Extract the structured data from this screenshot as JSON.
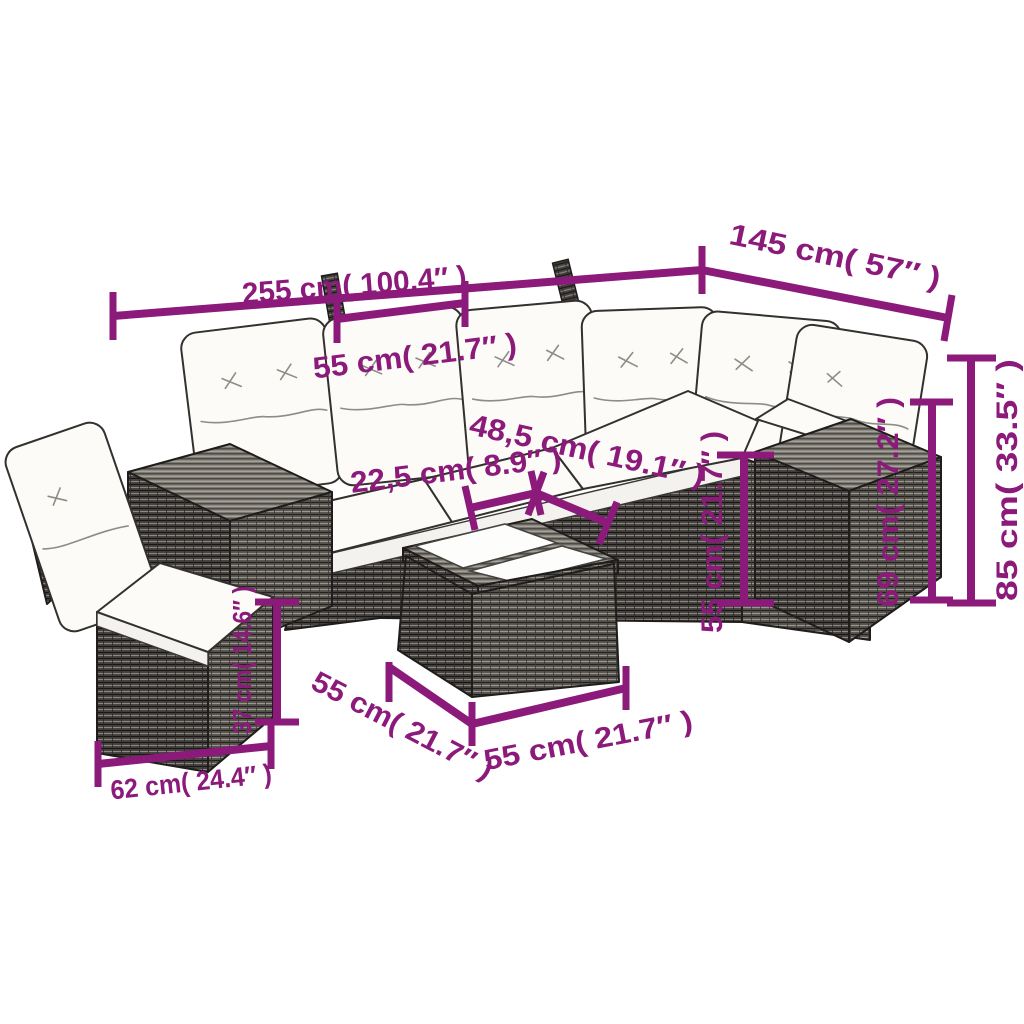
{
  "title": "rattan lounge set dimension diagram",
  "colors": {
    "accent": "#8b1a7b",
    "background": "#ffffff",
    "rattan_dark": "#44413e",
    "rattan_top": "#8e8a84",
    "cushion": "#fcfbf8"
  },
  "dimensions": {
    "total_width": "255 cm( 100.4″ )",
    "total_depth": "145 cm( 57″ )",
    "seat_width": "55 cm( 21.7″ )",
    "corner_seat_depth": "48,5 cm( 19.1″ )",
    "armrest_width": "22,5 cm( 8.9″ )",
    "seat_front_height": "55 cm( 21.7″ )",
    "armrest_box_height": "69 cm( 27.2″ )",
    "total_height": "85 cm( 33.5″ )",
    "chair_seat_height": "37 cm( 14.6″ )",
    "chair_width": "62 cm( 24.4″ )",
    "table_width": "55 cm( 21.7″ )",
    "table_depth": "55 cm( 21.7″ )"
  }
}
